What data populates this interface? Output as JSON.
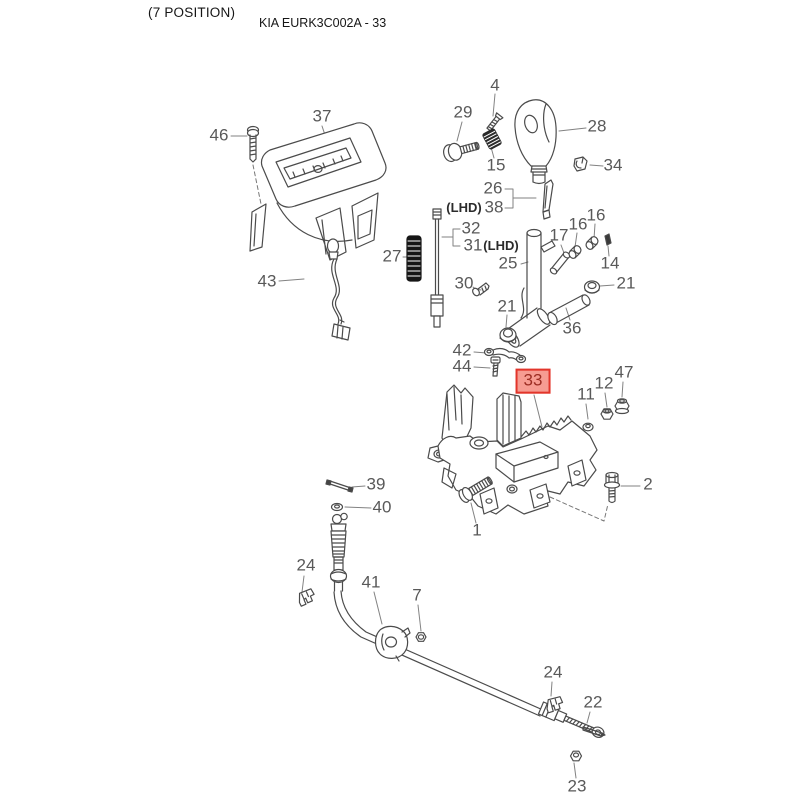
{
  "header": {
    "position_note": "(7 POSITION)",
    "title": "KIA EURK3C002A - 33"
  },
  "diagram": {
    "description": "Exploded parts diagram of gear shift lever control assembly",
    "selected_part": "33",
    "background_color": "#ffffff",
    "line_color": "#4b4b4b",
    "leader_line_color": "#808080",
    "label_color": "#595959",
    "highlight_border_color": "#e2352b",
    "highlight_fill_color": "#f69c92",
    "highlight_text_color": "#9c2d23"
  },
  "parts": [
    {
      "label": "46",
      "x": 219,
      "y": 136
    },
    {
      "label": "37",
      "x": 322,
      "y": 117
    },
    {
      "label": "43",
      "x": 267,
      "y": 282
    },
    {
      "label": "4",
      "x": 495,
      "y": 86
    },
    {
      "label": "29",
      "x": 463,
      "y": 113
    },
    {
      "label": "15",
      "x": 496,
      "y": 166
    },
    {
      "label": "28",
      "x": 597,
      "y": 127
    },
    {
      "label": "34",
      "x": 613,
      "y": 166
    },
    {
      "label": "26",
      "x": 493,
      "y": 189
    },
    {
      "label": "(LHD)",
      "x": 464,
      "y": 208,
      "kind": "note"
    },
    {
      "label": "38",
      "x": 494,
      "y": 208
    },
    {
      "label": "32",
      "x": 471,
      "y": 229
    },
    {
      "label": "31",
      "x": 473,
      "y": 246
    },
    {
      "label": "(LHD)",
      "x": 501,
      "y": 246,
      "kind": "note"
    },
    {
      "label": "27",
      "x": 392,
      "y": 257
    },
    {
      "label": "25",
      "x": 508,
      "y": 264
    },
    {
      "label": "17",
      "x": 559,
      "y": 236
    },
    {
      "label": "16",
      "x": 578,
      "y": 225
    },
    {
      "label": "16",
      "x": 596,
      "y": 216
    },
    {
      "label": "14",
      "x": 610,
      "y": 264
    },
    {
      "label": "21",
      "x": 626,
      "y": 284
    },
    {
      "label": "36",
      "x": 572,
      "y": 329
    },
    {
      "label": "30",
      "x": 464,
      "y": 284
    },
    {
      "label": "21",
      "x": 507,
      "y": 307
    },
    {
      "label": "42",
      "x": 462,
      "y": 351
    },
    {
      "label": "44",
      "x": 462,
      "y": 367
    },
    {
      "label": "33",
      "x": 533,
      "y": 381,
      "highlighted": true
    },
    {
      "label": "11",
      "x": 586,
      "y": 395
    },
    {
      "label": "12",
      "x": 604,
      "y": 384
    },
    {
      "label": "47",
      "x": 624,
      "y": 373
    },
    {
      "label": "2",
      "x": 648,
      "y": 485
    },
    {
      "label": "1",
      "x": 477,
      "y": 531
    },
    {
      "label": "39",
      "x": 376,
      "y": 485
    },
    {
      "label": "40",
      "x": 382,
      "y": 508
    },
    {
      "label": "24",
      "x": 306,
      "y": 566
    },
    {
      "label": "41",
      "x": 371,
      "y": 583
    },
    {
      "label": "7",
      "x": 417,
      "y": 596
    },
    {
      "label": "24",
      "x": 553,
      "y": 673
    },
    {
      "label": "22",
      "x": 593,
      "y": 703
    },
    {
      "label": "23",
      "x": 577,
      "y": 787
    }
  ]
}
